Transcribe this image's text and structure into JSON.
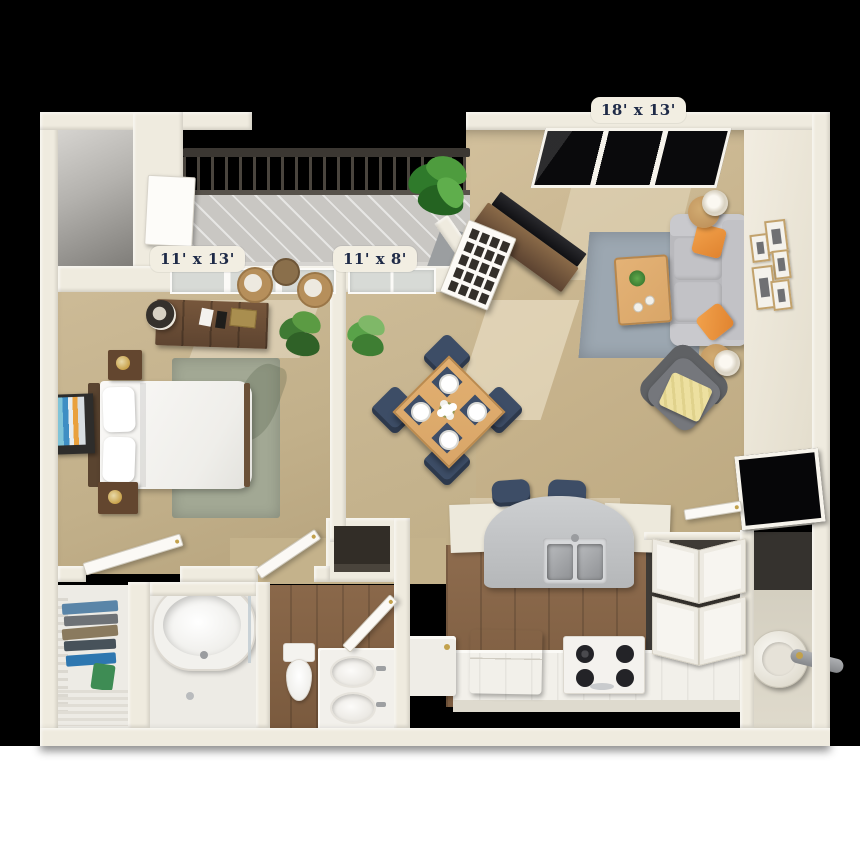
{
  "scene": {
    "description": "3D rendered one-bedroom apartment floor plan, top-down isometric view",
    "background_top": "#000000",
    "background_bottom": "#ffffff"
  },
  "labels": {
    "living_room": "18' x 13'",
    "bedroom": "11' x 13'",
    "dining": "11' x 8'"
  },
  "palette": {
    "wall": "#EFEBDF",
    "wall-face": "#E7E1D1",
    "carpet": "#C8B58F",
    "wood": "#8A684A",
    "balcony": "#C9C7C3",
    "railing": "#3B3732",
    "rug-sage": "#A2A894",
    "rug-blue": "#9CA7B1",
    "sofa": "#B9B9BD",
    "armchair": "#75777C",
    "pillow-orange": "#E0832F",
    "throw-yellow": "#EDE0A0",
    "oak": "#D9A668",
    "walnut": "#63462F",
    "navy": "#3D4D66",
    "plant": "#4E8C3C",
    "glass-dark": "#0A0A0C",
    "steel": "#A6A8AB",
    "label-bg": "#F2EEE2",
    "label-text": "#1E2A47",
    "bath-floor": "#EDEBE5"
  }
}
